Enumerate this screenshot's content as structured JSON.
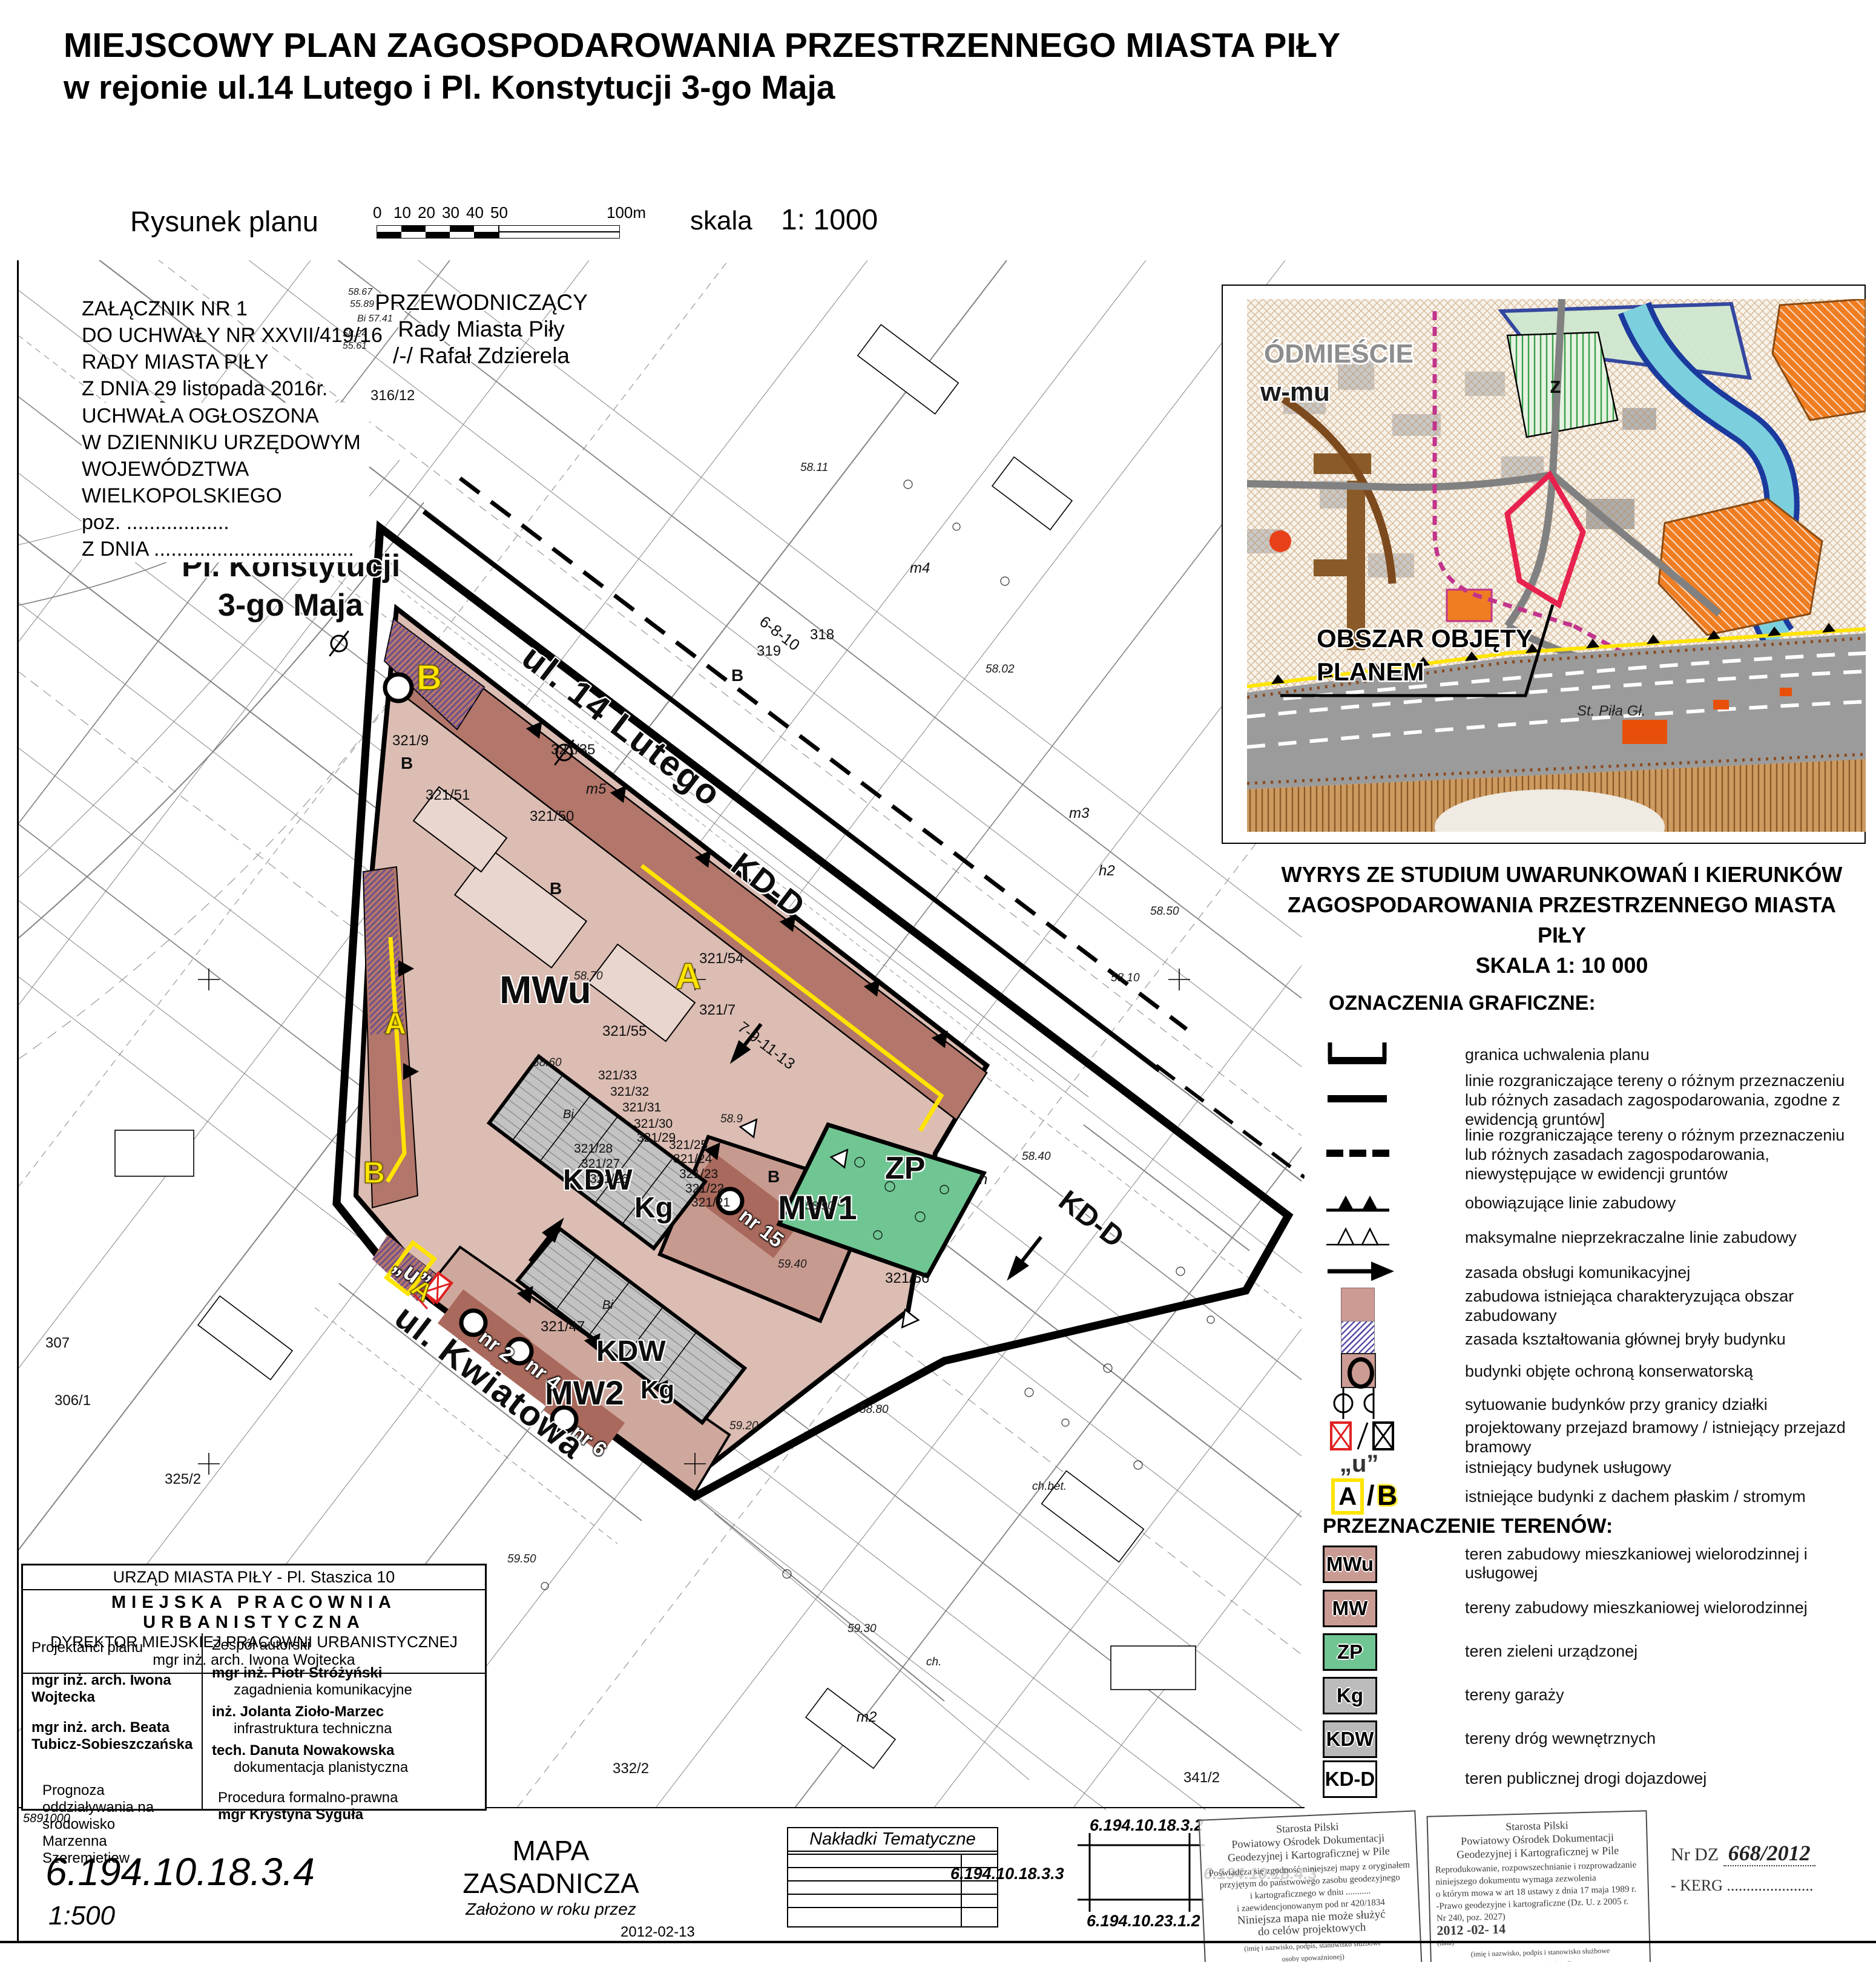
{
  "title": {
    "line1": "MIEJSCOWY PLAN ZAGOSPODAROWANIA PRZESTRZENNEGO MIASTA PIŁY",
    "line2": "w rejonie ul.14 Lutego i Pl. Konstytucji 3-go Maja"
  },
  "subtitle": {
    "drawing": "Rysunek planu",
    "scale_label": "skala",
    "scale_value": "1: 1000"
  },
  "scalebar": {
    "ticks": [
      "0",
      "10",
      "20",
      "30",
      "40",
      "50"
    ],
    "end_label": "100m"
  },
  "annex": {
    "l1": "ZAŁĄCZNIK NR 1",
    "l2": "DO UCHWAŁY NR XXVII/419/16",
    "l3": "RADY MIASTA PIŁY",
    "l4": "Z DNIA 29 listopada 2016r."
  },
  "publication": {
    "l1": "UCHWAŁA OGŁOSZONA",
    "l2": "W DZIENNIKU URZĘDOWYM",
    "l3": "WOJEWÓDZTWA",
    "l4": "WIELKOPOLSKIEGO",
    "l5": "poz. ..................",
    "l6": "Z DNIA ..................................."
  },
  "chairman": {
    "l1": "PRZEWODNICZĄCY",
    "l2": "Rady Miasta Piły",
    "l3": "/-/ Rafał Zdzierela"
  },
  "place_label": {
    "line1": "Pl. Konstytucji",
    "line2": "3-go Maja"
  },
  "streets": {
    "lutego": "ul. 14 Lutego",
    "kdd": "KD-D",
    "kwiatowa": "ul. Kwiatowa"
  },
  "zones": {
    "mwu": "MWu",
    "mw1": "MW1",
    "mw2": "MW2",
    "kdw": "KDW",
    "kg": "Kg",
    "zp": "ZP",
    "u": "„u”",
    "a": "A",
    "b": "B"
  },
  "house_numbers": {
    "n2": "nr 2",
    "n4": "nr 4",
    "n6": "nr 6",
    "n15": "nr 15"
  },
  "parcels": [
    "316/12",
    "318",
    "319",
    "321/54",
    "321/7",
    "321/55",
    "321/33",
    "321/32",
    "321/31",
    "321/30",
    "321/29",
    "321/25",
    "321/24",
    "321/23",
    "321/22",
    "321/21",
    "321/28",
    "321/27",
    "321/26",
    "321/47",
    "321/35",
    "321/50",
    "321/9",
    "321/51",
    "321/56",
    "325/2",
    "332/2",
    "341/2",
    "307",
    "306/1",
    "m2"
  ],
  "elevations": [
    "58.70",
    "58.60",
    "58.9",
    "58.90",
    "58.80",
    "58.40",
    "58.50",
    "58.10",
    "59.20",
    "59.30",
    "59.50",
    "58.11",
    "58.02",
    "59.40",
    "ch.bet.",
    "ch."
  ],
  "map_texts": [
    "m4",
    "m5",
    "m3",
    "h2",
    "h",
    "Bi",
    "Bi",
    "B",
    "B",
    "B",
    "B",
    "7-9-11-13",
    "6-8-10",
    "58.67",
    "55.89",
    "Bi 57.41",
    "58.24",
    "55.61"
  ],
  "inset": {
    "district": "ÓDMIEŚCIE",
    "district_sub": "w-mu",
    "zone_z": "z",
    "area_line1": "OBSZAR OBJĘTY",
    "area_line2": "PLANEM",
    "station": "St. Piła Gł.",
    "caption_line1": "WYRYS ZE  STUDIUM  UWARUNKOWAŃ I KIERUNKÓW",
    "caption_line2": "ZAGOSPODAROWANIA  PRZESTRZENNEGO  MIASTA PIŁY",
    "caption_line3": "SKALA     1:  10 000"
  },
  "legend": {
    "title": "OZNACZENIA GRAFICZNE:",
    "items": [
      {
        "label": "granica uchwalenia planu"
      },
      {
        "label": "linie rozgraniczające tereny o różnym przeznaczeniu lub różnych zasadach zagospodarowania, zgodne z ewidencją gruntów]"
      },
      {
        "label": "linie rozgraniczające tereny o różnym przeznaczeniu lub różnych zasadach zagospodarowania, niewystępujące w ewidencji gruntów"
      },
      {
        "label": "obowiązujące linie zabudowy"
      },
      {
        "label": "maksymalne nieprzekraczalne linie zabudowy"
      },
      {
        "label": "zasada  obsługi komunikacyjnej"
      },
      {
        "label": "zabudowa istniejąca charakteryzująca obszar zabudowany"
      },
      {
        "label": "zasada kształtowania głównej bryły budynku"
      },
      {
        "label": "budynki objęte ochroną konserwatorską"
      },
      {
        "label": "sytuowanie budynków przy granicy działki"
      },
      {
        "label": "projektowany przejazd bramowy / istniejący przejazd bramowy"
      },
      {
        "label": "istniejący budynek usługowy"
      },
      {
        "label": "istniejące budynki  z dachem płaskim / stromym"
      }
    ]
  },
  "landuse": {
    "title": "PRZEZNACZENIE TERENÓW:",
    "items": [
      {
        "code": "MWu",
        "color": "#c99b93",
        "label": "teren zabudowy mieszkaniowej wielorodzinnej i usługowej"
      },
      {
        "code": "MW",
        "color": "#c99b93",
        "label": "tereny zabudowy mieszkaniowej wielorodzinnej"
      },
      {
        "code": "ZP",
        "color": "#70c693",
        "label": "teren zieleni urządzonej"
      },
      {
        "code": "Kg",
        "color": "#bcbcbc",
        "label": "tereny garaży"
      },
      {
        "code": "KDW",
        "color": "#b9b9b9",
        "label": "tereny dróg wewnętrznych"
      },
      {
        "code": "KD-D",
        "color": "#ffffff",
        "label": "teren publicznej drogi dojazdowej"
      }
    ]
  },
  "credits": {
    "office": "URZĄD MIASTA PIŁY - Pl. Staszica 10",
    "studio": "MIEJSKA PRACOWNIA URBANISTYCZNA",
    "director_title": "DYREKTOR MIEJSKIEJ PRACOWNI URBANISTYCZNEJ",
    "director": "mgr inż. arch. Iwona Wojtecka",
    "designers_title": "Projektanci planu",
    "designer1": "mgr inż. arch. Iwona Wojtecka",
    "designer2": "mgr inż. arch. Beata Tubicz-Sobieszczańska",
    "prognosis_l1": "Prognoza",
    "prognosis_l2": "oddziaływania na środowisko",
    "prognosis_l3": "Marzenna Szeremietiew",
    "team_title": "Zespół autorski",
    "a1": "mgr inż. Piotr Stróżyński",
    "a1_role": "zagadnienia komunikacyjne",
    "a2": "inż. Jolanta Zioło-Marzec",
    "a2_role": "infrastruktura techniczna",
    "a3": "tech. Danuta Nowakowska",
    "a3_role": "dokumentacja planistyczna",
    "proc_title": "Procedura formalno-prawna",
    "proc_name": "mgr Krystyna Syguła"
  },
  "footer": {
    "coord": "5891000",
    "sheet_id": "6.194.10.18.3.4",
    "sheet_scale": "1:500",
    "map_name": "MAPA ZASADNICZA",
    "map_sub": "Założono w roku  przez",
    "overlays": "Nakładki Tematyczne",
    "idx_top": "6.194.10.18.3.2",
    "idx_left": "6.194.10.18.3.3",
    "idx_right": "6.194.10.18.4.3",
    "idx_bottom": "6.194.10.23.1.2",
    "date": "2012-02-13",
    "nr_dz": "Nr DZ",
    "nr_dz_value": "668/2012",
    "kerg": "- KERG ......................"
  },
  "stamps": {
    "s1": [
      "Starosta Pilski",
      "Powiatowy Ośrodek Dokumentacji",
      "Geodezyjnej i Kartograficznej w Pile",
      "Poświadcza się zgodność niniejszej mapy z oryginałem",
      "przyjętym do państwowego zasobu geodezyjnego",
      "i kartograficznego w dniu ...........",
      "i zaewidencjonowanym pod nr 420/1834",
      "Niniejsza mapa nie może służyć",
      "do celów projektowych",
      "(imię i nazwisko, podpis, stanowisko służbowe",
      "osoby upoważnionej)"
    ],
    "s2": [
      "Starosta Pilski",
      "Powiatowy Ośrodek Dokumentacji",
      "Geodezyjnej i Kartograficznej w Pile",
      "Reprodukowanie, rozpowszechnianie i rozprowadzanie",
      "niniejszego dokumentu wymaga zezwolenia",
      "o którym mowa w art 18 ustawy z dnia 17 maja 1989 r.",
      "-Prawo geodezyjne i kartograficzne (Dz. U. z 2005 r.",
      "Nr 240, poz. 2027)",
      "2012 -02- 14",
      "(data)",
      "(imię i nazwisko, podpis i stanowisko służbowe",
      "osoby upoważnionej)"
    ]
  },
  "colors": {
    "mwu": "#c99b93",
    "zp": "#70c693",
    "kg": "#bcbcbc",
    "kdw": "#b9b9b9",
    "kdd": "#ffffff",
    "yellow": "#ffe400",
    "red": "#e02020"
  }
}
